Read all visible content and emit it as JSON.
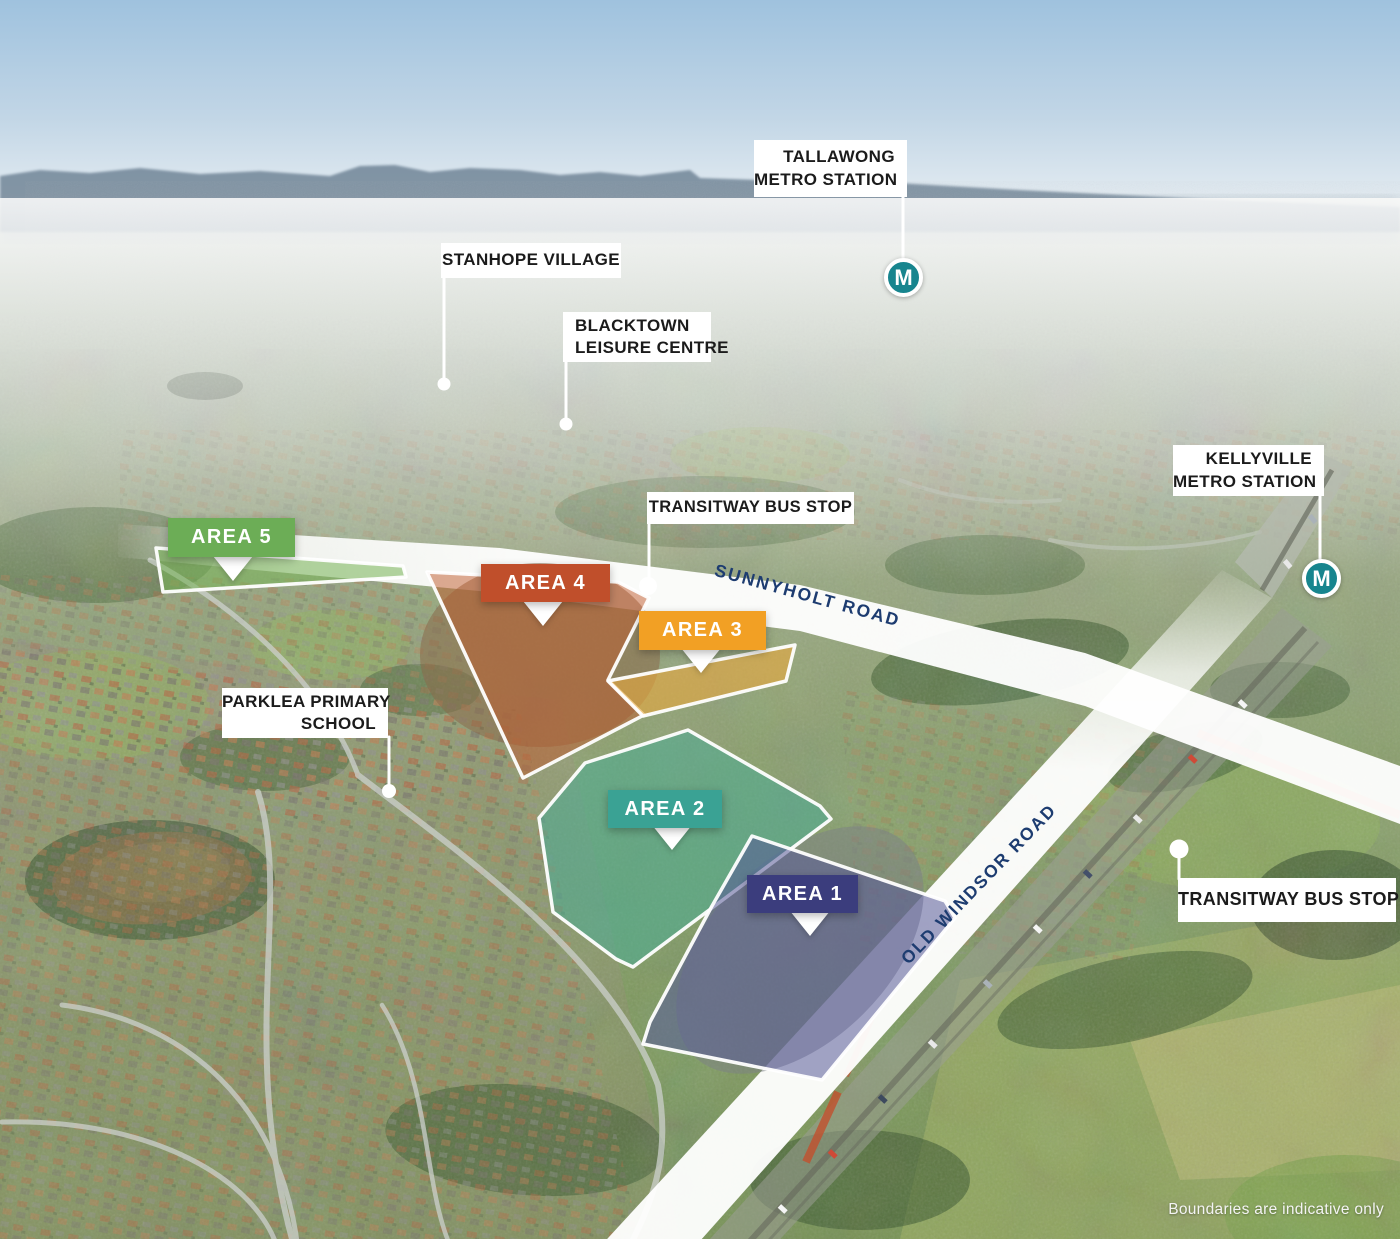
{
  "title": "Aerial masterplan location map",
  "disclaimer": "Boundaries are indicative only",
  "metro": {
    "letter": "M",
    "color": "#17858e"
  },
  "labels": {
    "tallawong": {
      "line1": "TALLAWONG",
      "line2": "METRO STATION"
    },
    "stanhope": {
      "line1": "STANHOPE VILLAGE"
    },
    "blacktown": {
      "line1": "BLACKTOWN",
      "line2": "LEISURE CENTRE"
    },
    "kellyville": {
      "line1": "KELLYVILLE",
      "line2": "METRO STATION"
    },
    "transitway_sunnyholt": {
      "line1": "TRANSITWAY BUS STOP"
    },
    "transitway_old_windsor": {
      "line1": "TRANSITWAY BUS STOP"
    },
    "parklea": {
      "line1": "PARKLEA PRIMARY",
      "line2": "SCHOOL"
    }
  },
  "roads": {
    "sunnyholt": "SUNNYHOLT ROAD",
    "old_windsor": "OLD WINDSOR ROAD",
    "label_color": "#1d3c70"
  },
  "areas": {
    "area1": {
      "label": "AREA 1",
      "badge_color": "#3b3d7d",
      "fill_color": "#585a99"
    },
    "area2": {
      "label": "AREA 2",
      "badge_color": "#3aa294",
      "fill_color": "#43ad97"
    },
    "area3": {
      "label": "AREA 3",
      "badge_color": "#f2a024",
      "fill_color": "#e9a93e"
    },
    "area4": {
      "label": "AREA 4",
      "badge_color": "#c04f2b",
      "fill_color": "#bf5a2b"
    },
    "area5": {
      "label": "AREA 5",
      "badge_color": "#6cad56",
      "fill_color": "#79b457"
    }
  }
}
